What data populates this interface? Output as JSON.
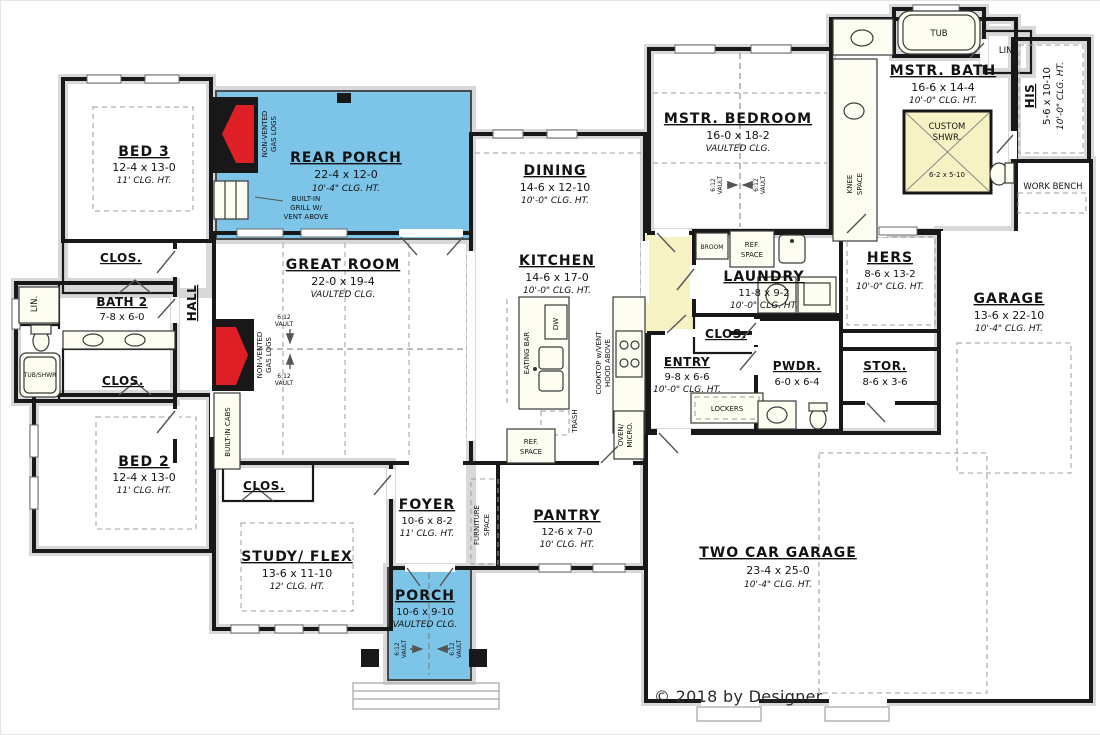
{
  "colors": {
    "room_fill": "#f7f2c4",
    "porch_fill": "#7cc4e8",
    "garage_fill": "#ffffff",
    "wall": "#181818",
    "fireplace_red": "#de1f26",
    "hatch_gray": "#d8d8d8"
  },
  "rooms": {
    "bed3": {
      "name": "BED 3",
      "dims": "12-4 x 13-0",
      "clg": "11' CLG. HT."
    },
    "rear_porch": {
      "name": "REAR PORCH",
      "dims": "22-4 x 12-0",
      "clg": "10'-4\" CLG. HT."
    },
    "clos_bed3": {
      "name": "CLOS."
    },
    "bath2": {
      "name": "BATH 2",
      "dims": "7-8 x 6-0"
    },
    "hall": {
      "name": "HALL"
    },
    "clos_bath2": {
      "name": "CLOS."
    },
    "bed2": {
      "name": "BED 2",
      "dims": "12-4 x 13-0",
      "clg": "11' CLG. HT."
    },
    "great_room": {
      "name": "GREAT ROOM",
      "dims": "22-0 x 19-4",
      "clg": "VAULTED CLG."
    },
    "dining": {
      "name": "DINING",
      "dims": "14-6 x 12-10",
      "clg": "10'-0\" CLG. HT."
    },
    "kitchen": {
      "name": "KITCHEN",
      "dims": "14-6 x 17-0",
      "clg": "10'-0\" CLG. HT."
    },
    "mstr_bedroom": {
      "name": "MSTR. BEDROOM",
      "dims": "16-0 x 18-2",
      "clg": "VAULTED CLG."
    },
    "mstr_bath": {
      "name": "MSTR. BATH",
      "dims": "16-6 x 14-4",
      "clg": "10'-0\" CLG. HT."
    },
    "his": {
      "name": "HIS",
      "dims": "5-6 x 10-10",
      "clg": "10'-0\" CLG. HT."
    },
    "hers": {
      "name": "HERS",
      "dims": "8-6 x 13-2",
      "clg": "10'-0\" CLG. HT."
    },
    "laundry": {
      "name": "LAUNDRY",
      "dims": "11-8 x 9-2",
      "clg": "10'-0\" CLG. HT."
    },
    "clos_laundry": {
      "name": "CLOS."
    },
    "entry": {
      "name": "ENTRY",
      "dims": "9-8 x 6-6",
      "clg": "10'-0\" CLG. HT."
    },
    "pwdr": {
      "name": "PWDR.",
      "dims": "6-0 x 6-4"
    },
    "stor": {
      "name": "STOR.",
      "dims": "8-6 x 3-6"
    },
    "garage": {
      "name": "GARAGE",
      "dims": "13-6 x 22-10",
      "clg": "10'-4\" CLG. HT."
    },
    "two_car_garage": {
      "name": "TWO CAR GARAGE",
      "dims": "23-4 x 25-0",
      "clg": "10'-4\" CLG. HT."
    },
    "foyer": {
      "name": "FOYER",
      "dims": "10-6 x 8-2",
      "clg": "11' CLG. HT."
    },
    "pantry": {
      "name": "PANTRY",
      "dims": "12-6 x 7-0",
      "clg": "10' CLG. HT."
    },
    "clos_study": {
      "name": "CLOS."
    },
    "study_flex": {
      "name": "STUDY/ FLEX",
      "dims": "13-6 x 11-10",
      "clg": "12' CLG. HT."
    },
    "porch": {
      "name": "PORCH",
      "dims": "10-6 x 9-10",
      "clg": "VAULTED CLG."
    }
  },
  "annotations": {
    "non_vented": [
      "NON-VENTED",
      "GAS LOGS"
    ],
    "grill": [
      "BUILT-IN",
      "GRILL W/",
      "VENT ABOVE"
    ],
    "built_in_cabs": "BUILT-IN CABS",
    "lin": "LIN.",
    "tub_shwr": "TUB/SHWR",
    "tub": "TUB",
    "custom_shwr": [
      "CUSTOM",
      "SHWR."
    ],
    "custom_shwr_dims": "6-2 x 5-10",
    "work_bench": "WORK BENCH",
    "knee_space": [
      "KNEE",
      "SPACE"
    ],
    "broom": "BROOM",
    "ref_space": [
      "REF.",
      "SPACE"
    ],
    "eating_bar": "EATING BAR",
    "dw": "DW",
    "trash": "TRASH",
    "cooktop": [
      "COOKTOP w/VENT",
      "HOOD ABOVE"
    ],
    "oven_micro": [
      "OVEN/",
      "MICRO."
    ],
    "lockers": "LOCKERS",
    "furniture_space": [
      "FURNITURE",
      "SPACE"
    ],
    "vault": [
      "6:12",
      "VAULT"
    ],
    "copyright": "© 2018 by Designer"
  }
}
